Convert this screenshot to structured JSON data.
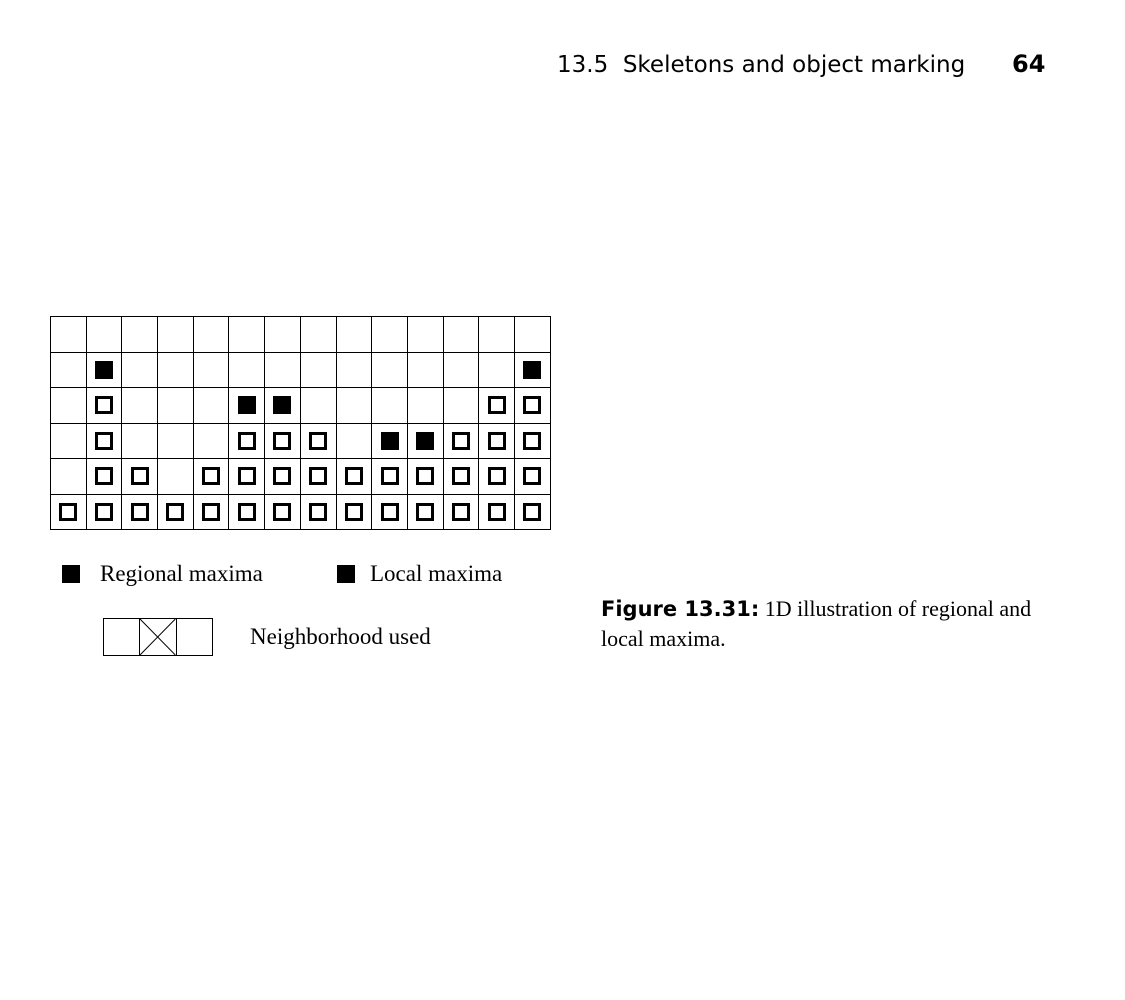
{
  "header": {
    "section": "13.5  Skeletons and object marking",
    "page_number": "64"
  },
  "figure": {
    "grid": {
      "columns": 14,
      "rows": 6,
      "cell_codes": {
        "empty": ".",
        "filled_black": "F",
        "outlined": "O"
      },
      "cells": [
        "..............",
        ".F...........F",
        ".O...FF.....OO",
        ".O...OOO.FFOOO",
        ".OO.OOOOOOOOOO",
        "OOOOOOOOOOOOOO"
      ]
    },
    "legend": {
      "regional_label": "Regional maxima",
      "local_label": "Local maxima"
    },
    "neighborhood": {
      "label": "Neighborhood used",
      "cells": 3,
      "center_marked": true
    }
  },
  "caption": {
    "label": "Figure 13.31:",
    "text": " 1D illustration of regional and local maxima."
  },
  "colors": {
    "ink": "#000000",
    "paper": "#ffffff"
  }
}
